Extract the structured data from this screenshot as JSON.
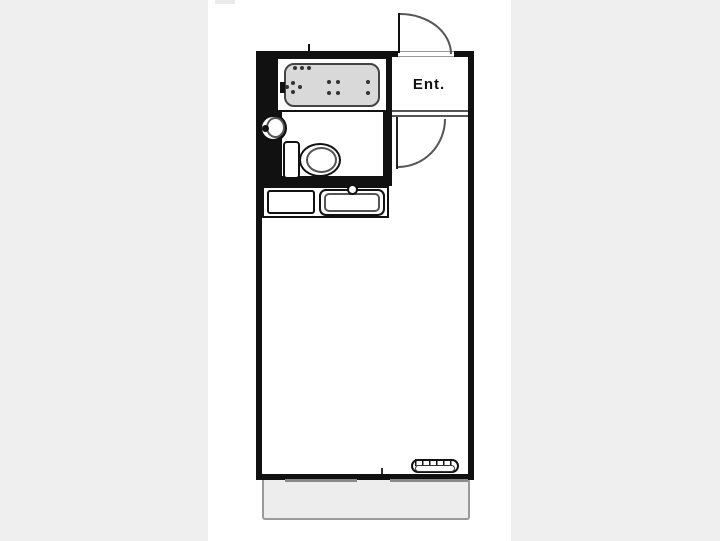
{
  "plan": {
    "entrance_label": "Ent.",
    "rooms": [
      "entrance",
      "bathroom",
      "toilet",
      "kitchen",
      "main-room",
      "balcony"
    ],
    "fixtures": [
      "bathtub",
      "washbasin",
      "toilet",
      "kitchen-sink",
      "kitchen-counter",
      "air-conditioner",
      "entrance-door",
      "bathroom-door",
      "balcony-window"
    ]
  },
  "colors": {
    "background": "#efefef",
    "plan_background": "#ffffff",
    "wall": "#111111",
    "tub_fill": "#d9d9d9",
    "balcony_fill": "#ededed",
    "balcony_border": "#9a9a9a",
    "fixture_line": "#555555",
    "thin_line": "#999999"
  }
}
